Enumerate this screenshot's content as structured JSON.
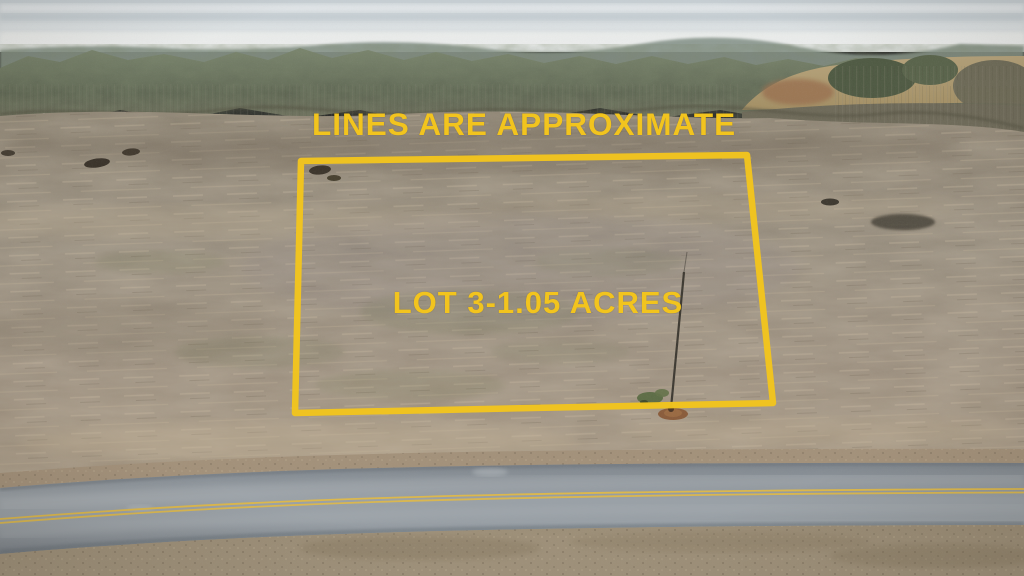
{
  "overlay": {
    "disclaimer": "LINES ARE APPROXIMATE",
    "lot_label": "LOT 3-1.05 ACRES"
  },
  "colors": {
    "accent_yellow": "#F2C41E",
    "road_line_yellow": "#DDB84A",
    "sky_gray": "#CDD4D7",
    "field_tan": "#97897A",
    "road_gray": "#9199A0",
    "tree_green": "#5E6552"
  }
}
